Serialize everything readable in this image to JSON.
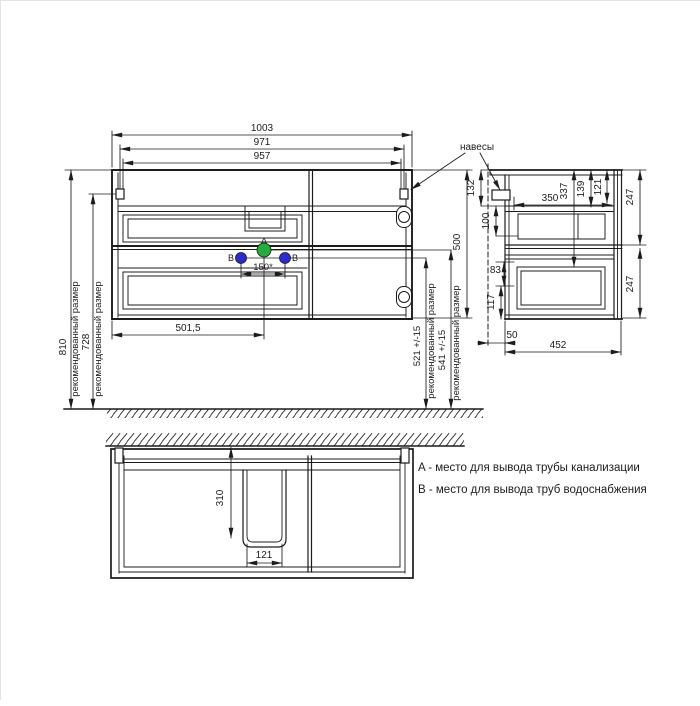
{
  "callouts": {
    "hangers": "навесы",
    "recommended_size": "рекомендованный размер",
    "point_a": "A",
    "point_b": "B"
  },
  "front_view": {
    "width_total": "1003",
    "width_hangers": "971",
    "width_holes": "957",
    "height_to_top": "810",
    "height_to_hangers": "728",
    "cabinet_height": "500",
    "height_water_pipes": "521 +/-15",
    "height_drain_pipe": "541 +/-15",
    "drain_offset_left": "501,5",
    "water_pipes_spacing": "150*"
  },
  "side_view": {
    "hanger_drop": "132",
    "hanger_depth": "350",
    "depth_337": "337",
    "depth_139": "139",
    "depth_121": "121",
    "back_clearance_height": "100",
    "gap_83": "83",
    "gap_117": "117",
    "wall_gap": "50",
    "cabinet_depth": "452",
    "section_height_top": "247",
    "section_height_bottom": "247"
  },
  "plan_view": {
    "cutout_depth": "310",
    "cutout_width": "121"
  },
  "legend": {
    "line_a": "A - место для вывода трубы канализации",
    "line_b": "B - место для вывода труб водоснабжения"
  },
  "colors": {
    "line": "#1c1c1c",
    "point_a_fill": "#23ae3b",
    "point_b_fill": "#2a2ad6"
  }
}
